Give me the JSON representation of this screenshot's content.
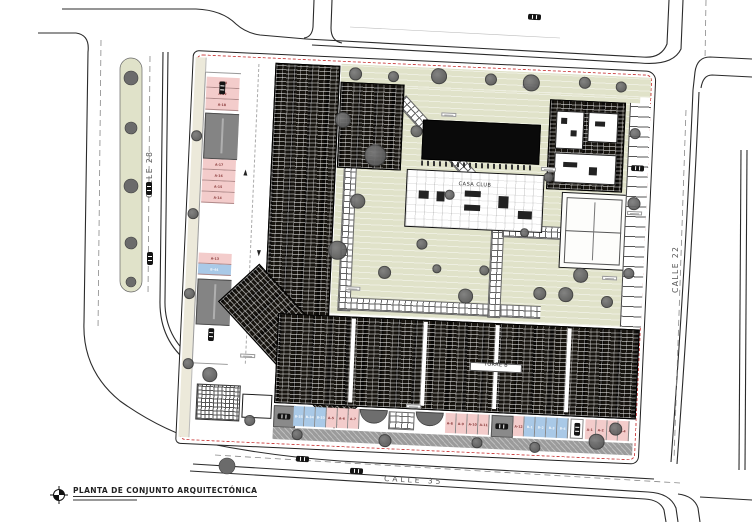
{
  "title_block": {
    "title": "PLANTA DE CONJUNTO ARQUITECTÓNICA"
  },
  "streets": {
    "left": "CALLE 28",
    "right": "CALLE 22",
    "bottom": "CALLE 35"
  },
  "site": {
    "casa_club_label": "CASA CLUB",
    "torre_b_label": "TORRE B"
  },
  "parking": {
    "left": {
      "upper": [
        {
          "label": "A-20",
          "type": "a"
        },
        {
          "label": "A-19",
          "type": "a"
        },
        {
          "label": "A-18",
          "type": "a"
        }
      ],
      "middle": [
        {
          "label": "A-17",
          "type": "a"
        },
        {
          "label": "A-16",
          "type": "a"
        },
        {
          "label": "A-15",
          "type": "a"
        },
        {
          "label": "A-14",
          "type": "a"
        }
      ],
      "lower": [
        {
          "label": "A-13",
          "type": "a"
        },
        {
          "label": "B-44",
          "type": "b"
        }
      ]
    },
    "bottom": {
      "g1": [
        {
          "label": "B-35",
          "type": "b"
        },
        {
          "label": "B-34",
          "type": "b"
        },
        {
          "label": "B-33",
          "type": "b"
        },
        {
          "label": "A-5",
          "type": "a"
        },
        {
          "label": "A-6",
          "type": "a"
        },
        {
          "label": "A-7",
          "type": "a"
        }
      ],
      "g2": [
        {
          "label": "A-8",
          "type": "a"
        },
        {
          "label": "A-9",
          "type": "a"
        },
        {
          "label": "A-10",
          "type": "a"
        },
        {
          "label": "A-11",
          "type": "a"
        }
      ],
      "g3": [
        {
          "label": "A-12",
          "type": "a"
        },
        {
          "label": "B-1",
          "type": "b"
        },
        {
          "label": "B-2",
          "type": "b"
        },
        {
          "label": "B-3",
          "type": "b"
        },
        {
          "label": "B-4",
          "type": "b"
        }
      ],
      "g4": [
        {
          "label": "A-1",
          "type": "a"
        },
        {
          "label": "A-2",
          "type": "a"
        },
        {
          "label": "A-3",
          "type": "a"
        },
        {
          "label": "A-4",
          "type": "a"
        }
      ]
    }
  },
  "colors": {
    "stall_type_a": "#f3cccb",
    "stall_type_b": "#a9c9e7",
    "landscape_green": "#e0e2c9",
    "tree_gray": "#6b6b6b",
    "property_line_red": "#cc4444",
    "road_line": "#2b2b2b",
    "building_black": "#17140f"
  }
}
